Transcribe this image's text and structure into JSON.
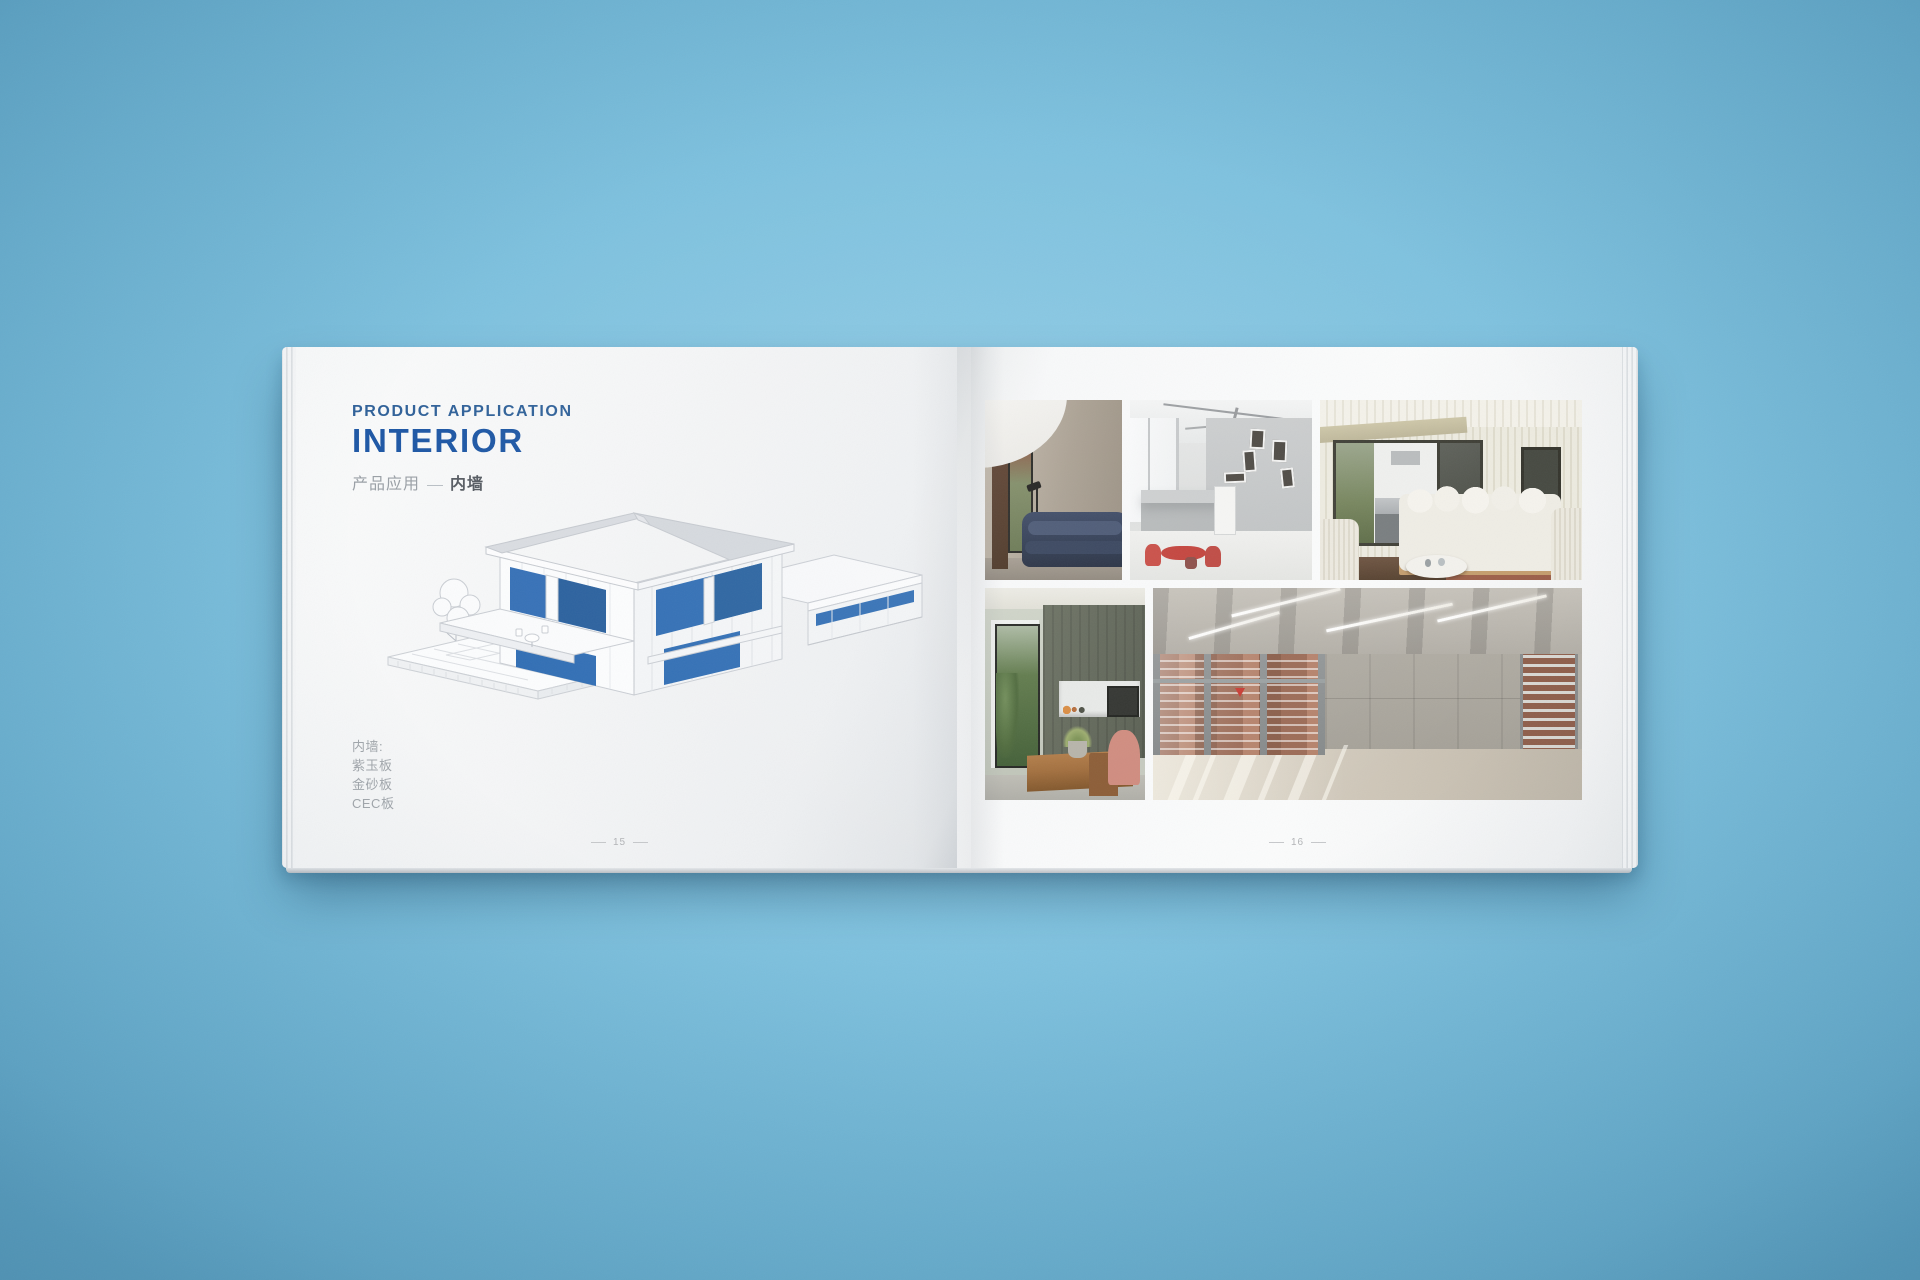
{
  "book": {
    "left_page": {
      "eyebrow": "PRODUCT APPLICATION",
      "title": "INTERIOR",
      "subtitle": "产品应用",
      "subtitle_emphasis": "内墙",
      "materials_title": "内墙:",
      "materials": [
        "紫玉板",
        "金砂板",
        "CEC板"
      ],
      "page_number": "15",
      "illustration": "isometric cutaway house with blue interior wall panels"
    },
    "right_page": {
      "page_number": "16",
      "photos": [
        {
          "alt": "lounge with concrete wall, curved white ceiling and navy sofa"
        },
        {
          "alt": "tall white loft space with scattered small windows and red dining set"
        },
        {
          "alt": "cream ribbed veranda lounge with white sofa and outdoor kitchen"
        },
        {
          "alt": "dining room with olive timber wall, pass-through hatch and plants"
        },
        {
          "alt": "empty concrete hall with full-height glazing and brick view"
        }
      ]
    },
    "colors": {
      "background": "#7cc0dd",
      "eyebrow_blue": "#2f6199",
      "title_blue": "#1d57a5",
      "illustration_blue": "#2f6db4",
      "muted_text": "#9aa0a6"
    }
  }
}
